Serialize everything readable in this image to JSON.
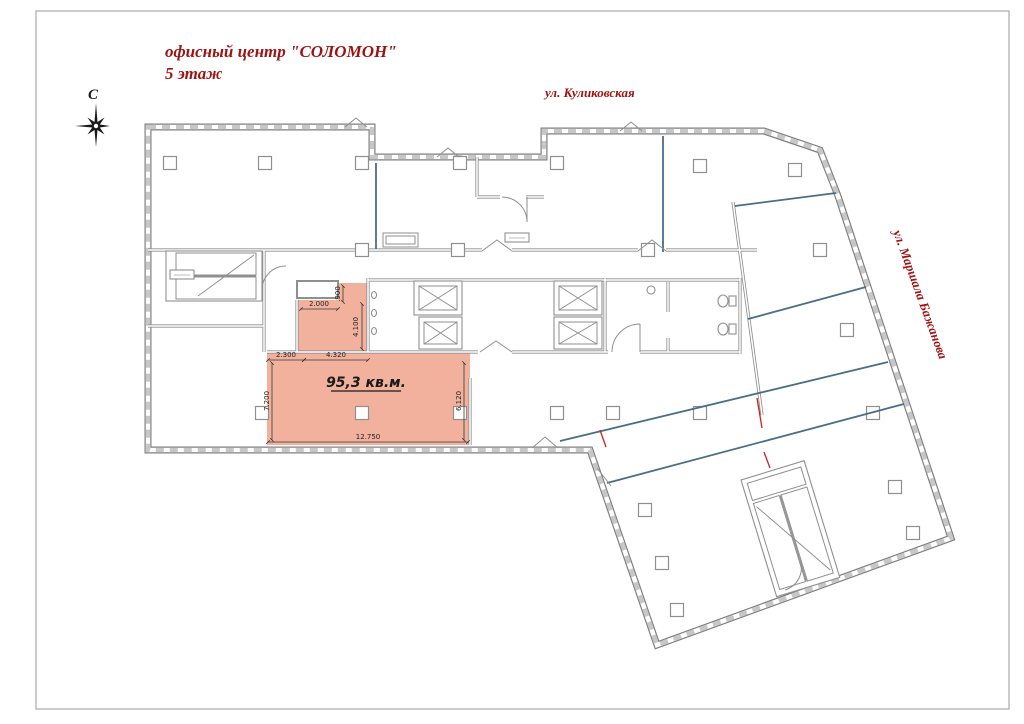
{
  "document": {
    "type": "floor-plan-drawing",
    "title_line1": "офисный центр \"СОЛОМОН\"",
    "title_line2": "5 этаж"
  },
  "compass": {
    "north_label": "С"
  },
  "streets": {
    "top": "ул. Куликовская",
    "right": "ул. Маршала Бажанова"
  },
  "highlighted_room": {
    "area_label": "95,3 кв.м.",
    "dimensions": {
      "inset_width": "2.000",
      "inset_height": ".900",
      "notch_height": "4.100",
      "top_left_segment": "2.300",
      "top_right_segment": "4.320",
      "left_height": "7.200",
      "right_height": "6.120",
      "bottom_width": "12.750"
    }
  },
  "colors": {
    "accent_red": "#9e1212",
    "room_fill": "#f2b19d",
    "wall_gray": "#8f8f8f",
    "partition_blue": "#4b6d87"
  }
}
